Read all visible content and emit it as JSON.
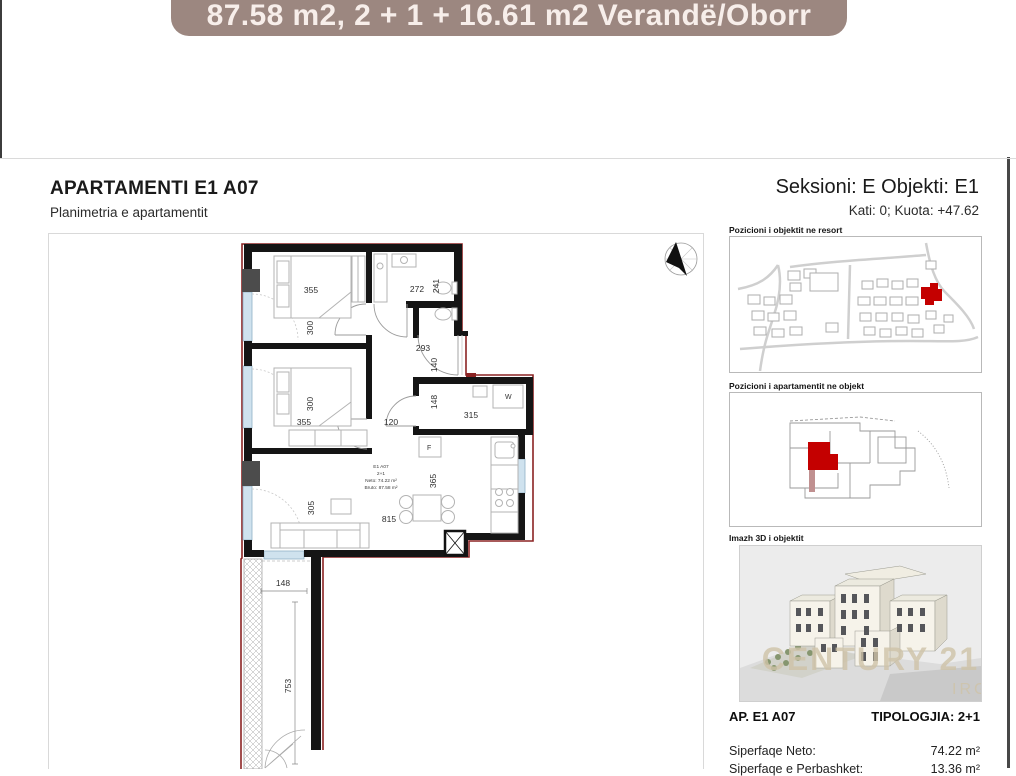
{
  "banner": {
    "text": "87.58 m2, 2 + 1 + 16.61 m2 Verandë/Oborr",
    "bg": "#9c8780"
  },
  "header": {
    "title": "APARTAMENTI E1 A07",
    "subtitle": "Planimetria e apartamentit",
    "section": "Seksioni: E Objekti: E1",
    "level": "Kati: 0; Kuota: +47.62"
  },
  "plan": {
    "dims": {
      "bed1_w": "355",
      "bed1_h": "300",
      "bath1_w": "272",
      "bath1_h": "241",
      "corridor_w": "293",
      "corridor_h": "140",
      "bed2_h": "300",
      "bed2_w": "355",
      "hall_w": "120",
      "bath2_h": "148",
      "bath2_w": "315",
      "kitchen_h": "365",
      "living_h": "305",
      "living_w": "815",
      "veranda_w": "148",
      "veranda_h": "753"
    },
    "fixtures": {
      "washer": "W",
      "fridge": "F"
    },
    "info": [
      "E1 A07",
      "2+1",
      "Neto: 74.22 m²",
      "Bruto: 87.58 m²"
    ]
  },
  "sidebar": {
    "map1_label": "Pozicioni i objektit ne resort",
    "map2_label": "Pozicioni i apartamentit ne objekt",
    "image3d_label": "Imazh 3D i objektit",
    "watermark1": "CENTURY 21.",
    "watermark2": "IRG",
    "ap_label": "AP. E1 A07",
    "tipologjia": "TIPOLOGJIA: 2+1",
    "rows": [
      {
        "label": "Siperfaqe Neto:",
        "value": "74.22 m²"
      },
      {
        "label": "Siperfaqe e Perbashket:",
        "value": "13.36 m²"
      }
    ]
  }
}
